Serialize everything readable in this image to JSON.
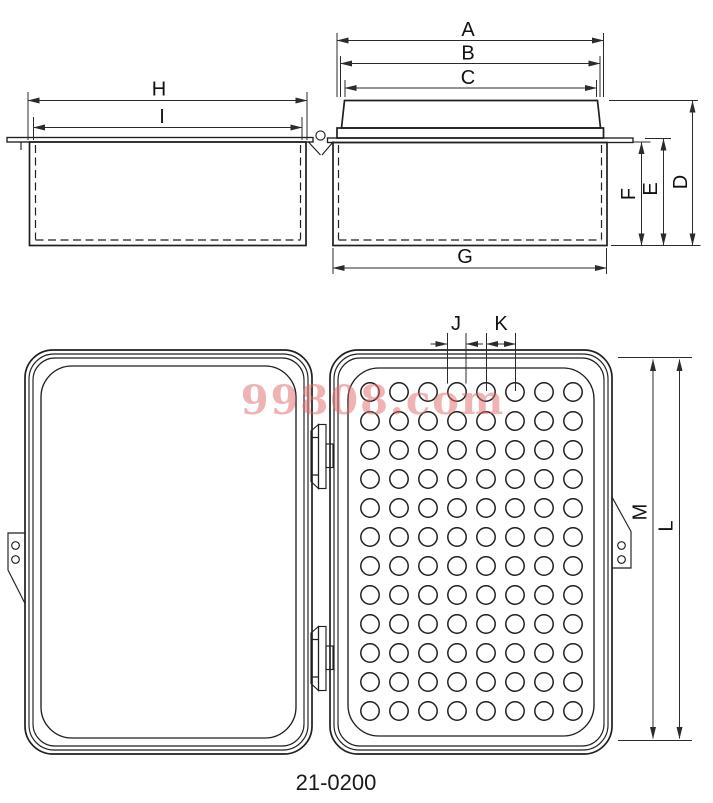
{
  "drawing": {
    "part_number": "21-0200",
    "watermark": "99808.com",
    "dimension_labels": {
      "A": "A",
      "B": "B",
      "C": "C",
      "D": "D",
      "E": "E",
      "F": "F",
      "G": "G",
      "H": "H",
      "I": "I",
      "J": "J",
      "K": "K",
      "L": "L",
      "M": "M"
    },
    "hole_grid": {
      "rows": 12,
      "cols": 8,
      "start_x": 370,
      "start_y": 392,
      "spacing_x": 29,
      "spacing_y": 29,
      "radius": 9.2
    },
    "colors": {
      "line": "#1f1f1f",
      "dimension": "#2b2b2b",
      "watermark": "#e06a6a"
    }
  }
}
